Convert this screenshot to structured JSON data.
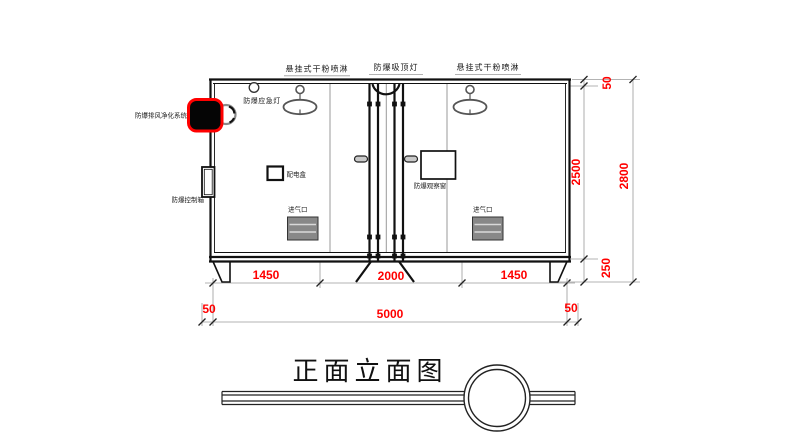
{
  "title": "正面立面图",
  "labels": {
    "sprinkler_left": "悬挂式干粉喷淋",
    "ceiling_light": "防爆吸顶灯",
    "sprinkler_right": "悬挂式干粉喷淋",
    "emergency_light": "防爆应急灯",
    "exhaust_system": "防爆排风净化系统",
    "control_box": "防爆控制箱",
    "power_box": "配电盒",
    "observation_window": "防爆观察窗",
    "air_inlet_left": "进气口",
    "air_inlet_right": "进气口"
  },
  "dimensions": {
    "bottom_segments": [
      "1450",
      "2000",
      "1450"
    ],
    "total_width": "5000",
    "margin_left": "50",
    "margin_right": "50",
    "side_top": "50",
    "side_height": "2500",
    "side_base": "250",
    "side_total": "2800"
  },
  "colors": {
    "dimension_text": "#ff0000",
    "highlight": "#ff0000",
    "line": "#111111",
    "partition": "#9a9a9a"
  }
}
